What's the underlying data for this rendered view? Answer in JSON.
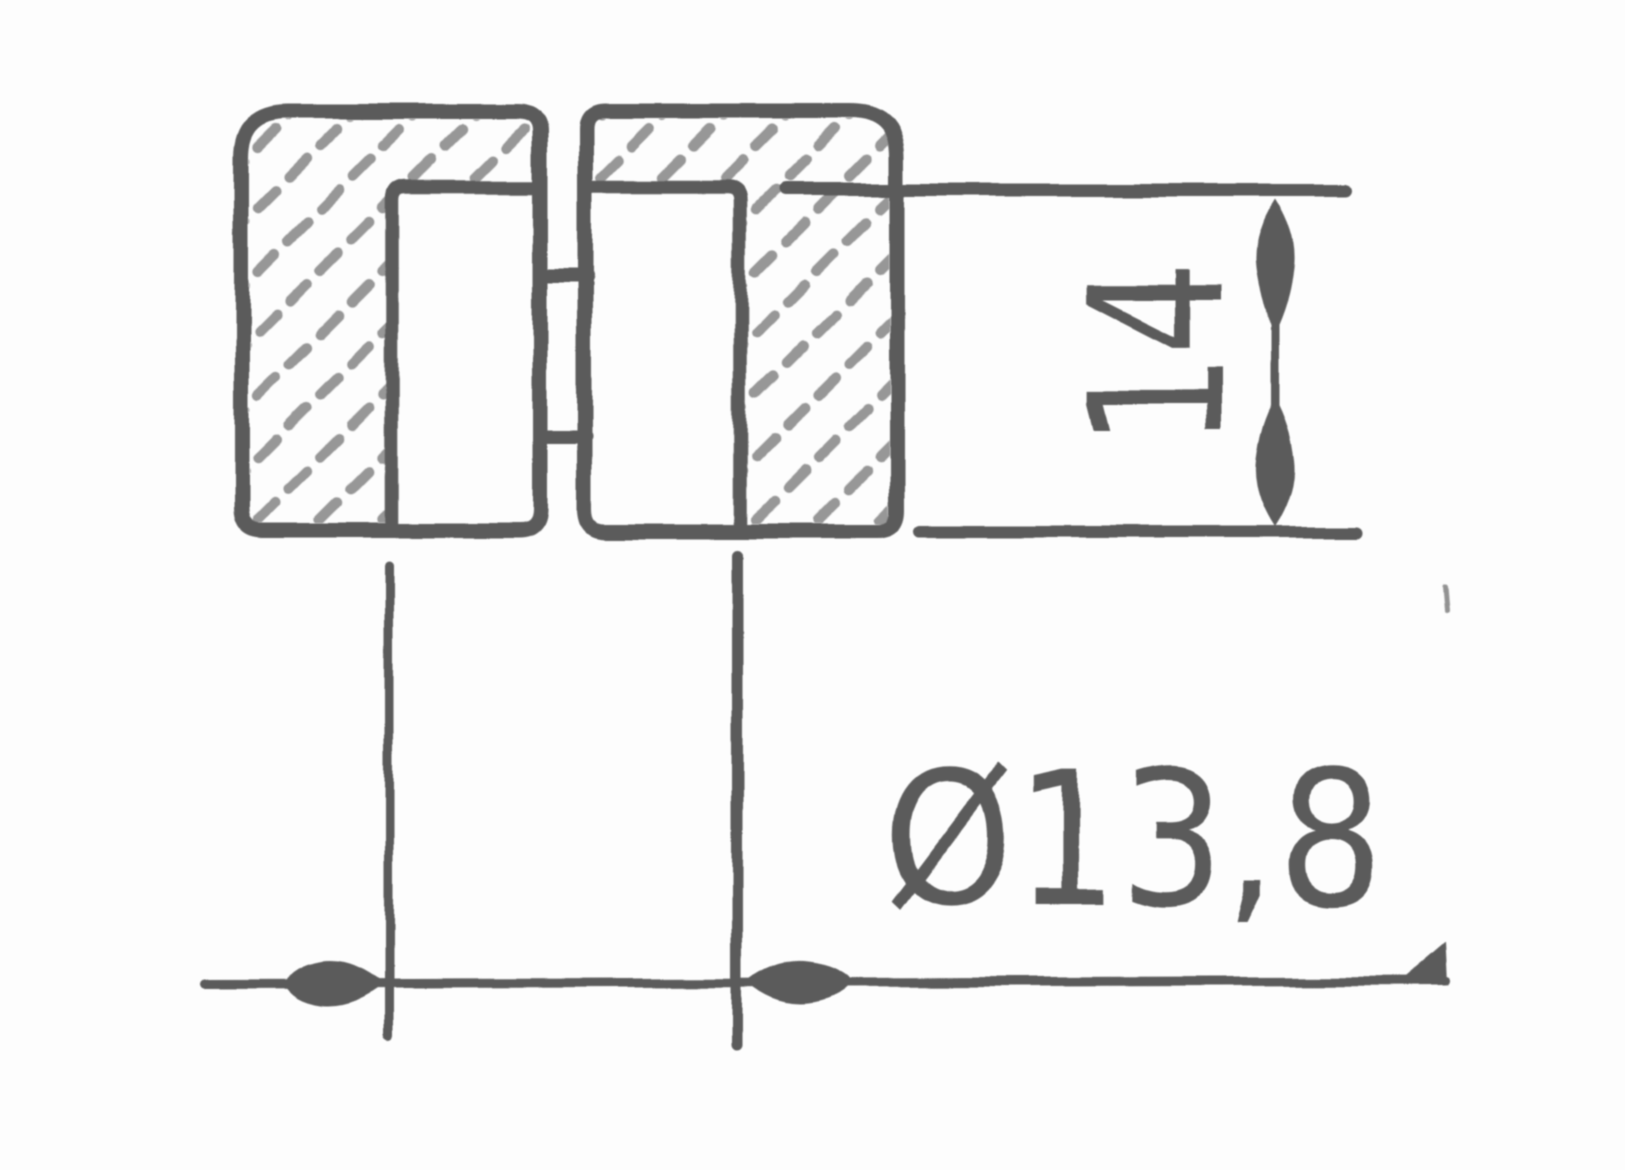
{
  "drawing": {
    "kind": "hand-drawn technical section sketch",
    "subject": "split bushing / sleeve cross-section with hatched cut surfaces",
    "background_color": "#fdfdfd",
    "ink_color": "#4d4d4d",
    "hatch_color": "#6b6b6b",
    "dimensions": {
      "height": {
        "label": "14",
        "orientation": "vertical",
        "unit": "mm"
      },
      "diameter": {
        "label": "Ø13,8",
        "orientation": "horizontal",
        "unit": "mm"
      }
    }
  }
}
